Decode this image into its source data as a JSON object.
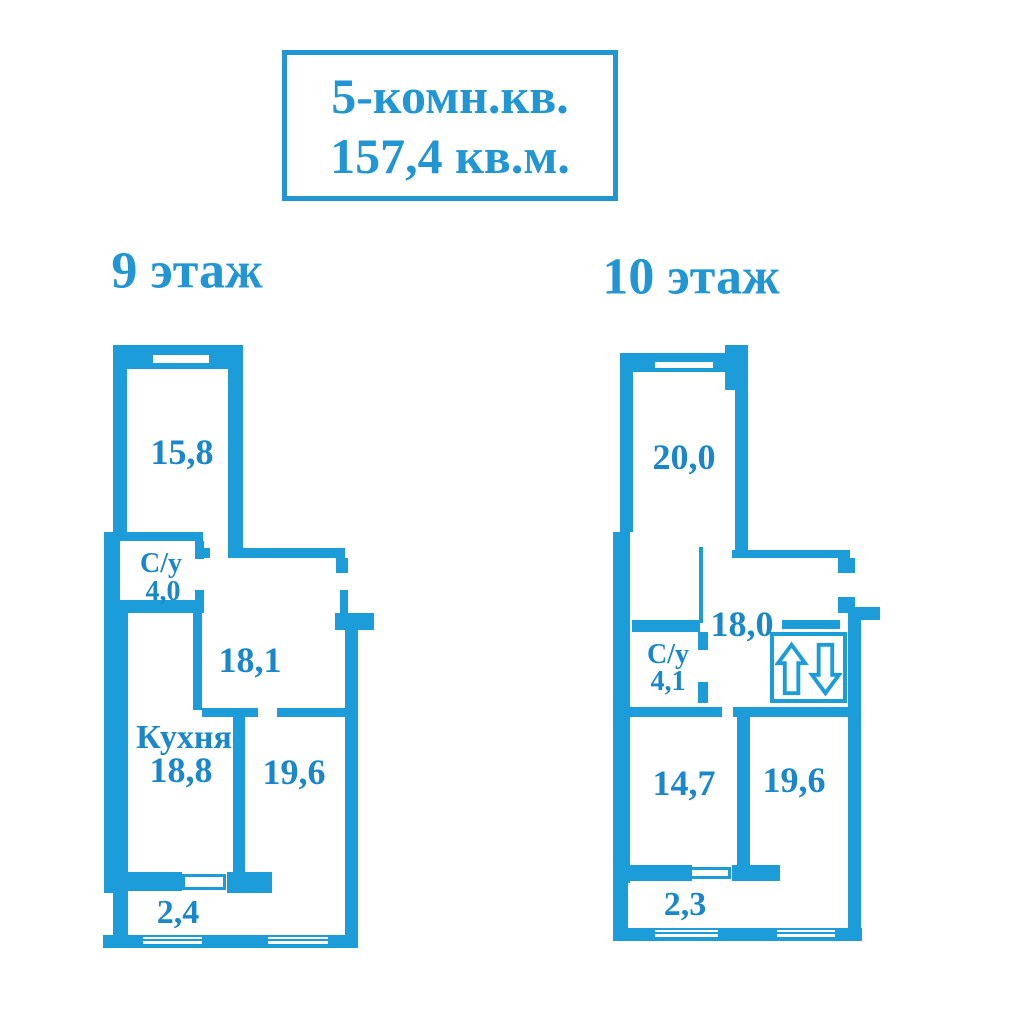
{
  "title_box": {
    "line1": "5-комн.кв.",
    "line2": "157,4 кв.м."
  },
  "colors": {
    "wall": "#1c9cd9",
    "label_text": "#1987c9",
    "title_text": "#2196d3"
  },
  "icons": {
    "elevator": "elevator-up-down-arrows"
  },
  "floors": {
    "floor9": {
      "label": "9 этаж",
      "rooms": {
        "room_top": "15,8",
        "bathroom_name": "С/у",
        "bathroom_area": "4,0",
        "hall": "18,1",
        "kitchen_name": "Кухня",
        "kitchen_area": "18,8",
        "room_right": "19,6",
        "balcony": "2,4"
      }
    },
    "floor10": {
      "label": "10 этаж",
      "rooms": {
        "room_top": "20,0",
        "hall": "18,0",
        "bathroom_name": "С/у",
        "bathroom_area": "4,1",
        "room_left": "14,7",
        "room_right": "19,6",
        "balcony": "2,3"
      }
    }
  }
}
